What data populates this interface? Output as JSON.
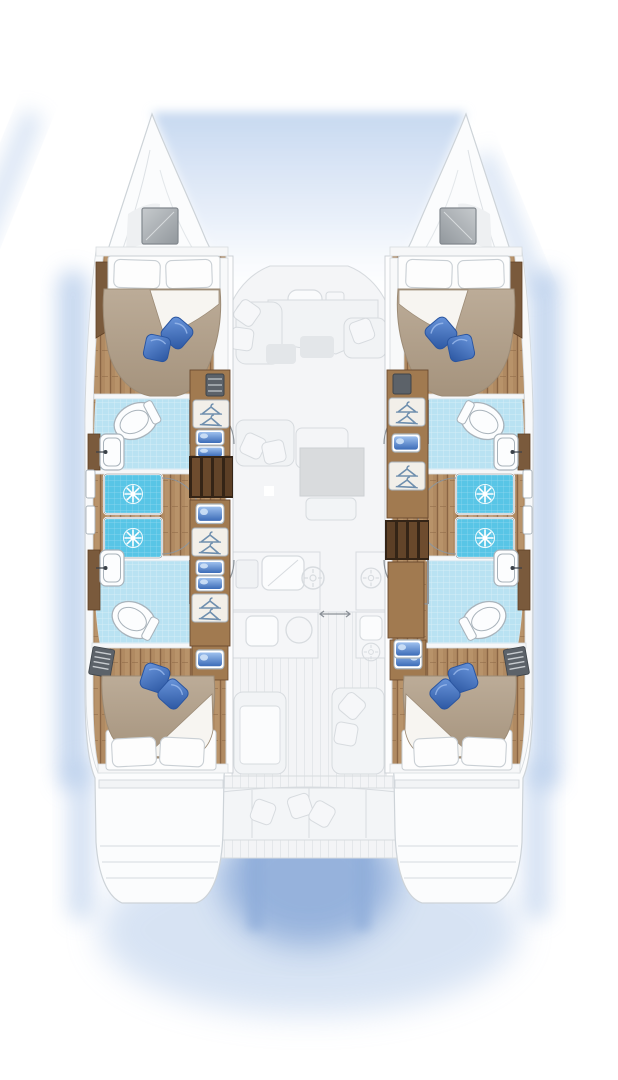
{
  "meta": {
    "title": "Catamaran interior layout plan",
    "view": "top-down floor plan, bow at top",
    "style": "rendered illustration, no text labels",
    "summary": "4-cabin / 4-head sailing catamaran: mirrored port and starboard hulls each with a forward double cabin, two shower stalls, two heads and an aft double cabin; ghosted saloon, galley and aft cockpit on the bridge deck"
  },
  "colors": {
    "bg": "#ffffff",
    "ghost_fill": "#f4f5f7",
    "ghost_stroke": "#d7dbdf",
    "ghost_dark": "#e3e6e9",
    "hull_white": "#fbfcfd",
    "deck_white": "#f8f9fa",
    "glow_blue": "#b7cdeb",
    "wash_blue": "#ccdcf2",
    "shadow_blue": "#8fadda",
    "wood_floor": "#b08a62",
    "wood_light": "#c7a47c",
    "wood_dark": "#8a6544",
    "wood_trim": "#7a5a3c",
    "cabinet_wood": "#a17a50",
    "stairs_dark": "#342416",
    "stairs_tread": "#6e4c2e",
    "bed_tan": "#b6a692",
    "bed_tan_dark": "#9c8b76",
    "sheet_white": "#f7f5f1",
    "pillow_white": "#fdfdfd",
    "pillow_stroke": "#c9cfd4",
    "blue_pillow": "#3c6fc5",
    "blue_pillow_dark": "#2a55a0",
    "blue_pillow_light": "#6b97dd",
    "shower_cyan": "#58c5e6",
    "bath_blue": "#b9e2f2",
    "fixture_white": "#fcfdfe",
    "fixture_stroke": "#a9b3bb",
    "sink_blue": "#5b8fd6",
    "sink_blue_dark": "#3562ad",
    "hanger_blue": "#6f8fae",
    "vent_gray": "#5c6269",
    "hatch_gray": "#b0b4b8",
    "arc_stroke": "#8e959b"
  },
  "vessel": {
    "label": "Sailing catamaran floor plan",
    "cabins": 4,
    "heads": 4,
    "shower_stalls": 4
  },
  "port_hull": {
    "label": "Port hull",
    "rooms": [
      {
        "id": "port-forward-cabin",
        "label": "Port forward double cabin",
        "features": [
          "island double bed",
          "two white pillows",
          "beige duvet with turned-down sheet",
          "two blue decorative cushions",
          "wardrobe with hangers",
          "storage bins"
        ]
      },
      {
        "id": "port-forward-head",
        "label": "Port forward head",
        "features": [
          "toilet",
          "washbasin",
          "door"
        ]
      },
      {
        "id": "port-shower-forward",
        "label": "Port forward shower stall",
        "features": [
          "cyan tiled floor",
          "drain rosette",
          "curved door"
        ]
      },
      {
        "id": "port-shower-aft",
        "label": "Port aft shower stall",
        "features": [
          "cyan tiled floor",
          "drain rosette",
          "curved door"
        ]
      },
      {
        "id": "port-aft-head",
        "label": "Port aft head",
        "features": [
          "toilet",
          "washbasin",
          "door"
        ]
      },
      {
        "id": "port-aft-cabin",
        "label": "Port aft double cabin",
        "features": [
          "island double bed",
          "two white pillows",
          "beige duvet with turned-down sheet",
          "two blue decorative cushions",
          "vanity basin",
          "louvered vent"
        ]
      },
      {
        "id": "port-companionway",
        "label": "Port companionway stairs",
        "features": [
          "dark wood steps to saloon"
        ]
      }
    ]
  },
  "starboard_hull": {
    "label": "Starboard hull (mirror of port)",
    "rooms": [
      {
        "id": "stbd-forward-cabin",
        "label": "Starboard forward double cabin",
        "features": [
          "island double bed",
          "two white pillows",
          "beige duvet",
          "two blue decorative cushions",
          "wardrobe with hangers",
          "storage bins"
        ]
      },
      {
        "id": "stbd-forward-head",
        "label": "Starboard forward head",
        "features": [
          "toilet",
          "washbasin",
          "door"
        ]
      },
      {
        "id": "stbd-shower-forward",
        "label": "Starboard forward shower stall",
        "features": [
          "cyan tiled floor",
          "drain rosette",
          "curved door"
        ]
      },
      {
        "id": "stbd-shower-aft",
        "label": "Starboard aft shower stall",
        "features": [
          "cyan tiled floor",
          "drain rosette",
          "curved door"
        ]
      },
      {
        "id": "stbd-aft-head",
        "label": "Starboard aft head",
        "features": [
          "toilet",
          "washbasin",
          "door"
        ]
      },
      {
        "id": "stbd-aft-cabin",
        "label": "Starboard aft double cabin",
        "features": [
          "island double bed",
          "vanity basin"
        ]
      },
      {
        "id": "stbd-companionway",
        "label": "Starboard companionway stairs",
        "features": [
          "dark wood steps to saloon"
        ]
      }
    ]
  },
  "bridge_deck": {
    "label": "Bridge deck (ghosted upper level)",
    "foredeck": {
      "label": "Foredeck between bows",
      "features": [
        "deck hatches on each bow"
      ]
    },
    "saloon": {
      "label": "Saloon (ghosted)",
      "features": [
        "U-shaped sofa with scatter cushions",
        "coffee table",
        "forward console seat",
        "dining table"
      ]
    },
    "galley": {
      "label": "Galley (ghosted)",
      "features": [
        "double sink",
        "hob burners",
        "worktops",
        "sliding door arrows"
      ]
    },
    "cockpit": {
      "label": "Aft cockpit (ghosted)",
      "features": [
        "transverse stern bench with cushions",
        "side seats",
        "teak-effect deck planking",
        "transom steps on both hulls"
      ]
    }
  },
  "icons": [
    "toilet-icon",
    "washbasin-icon",
    "shower-drain-icon",
    "clothes-hanger-icon",
    "storage-bin-icon",
    "stairs-icon",
    "deck-hatch-icon",
    "louver-vent-icon",
    "door-swing-arc-icon",
    "burner-icon",
    "sliding-door-arrows-icon"
  ]
}
